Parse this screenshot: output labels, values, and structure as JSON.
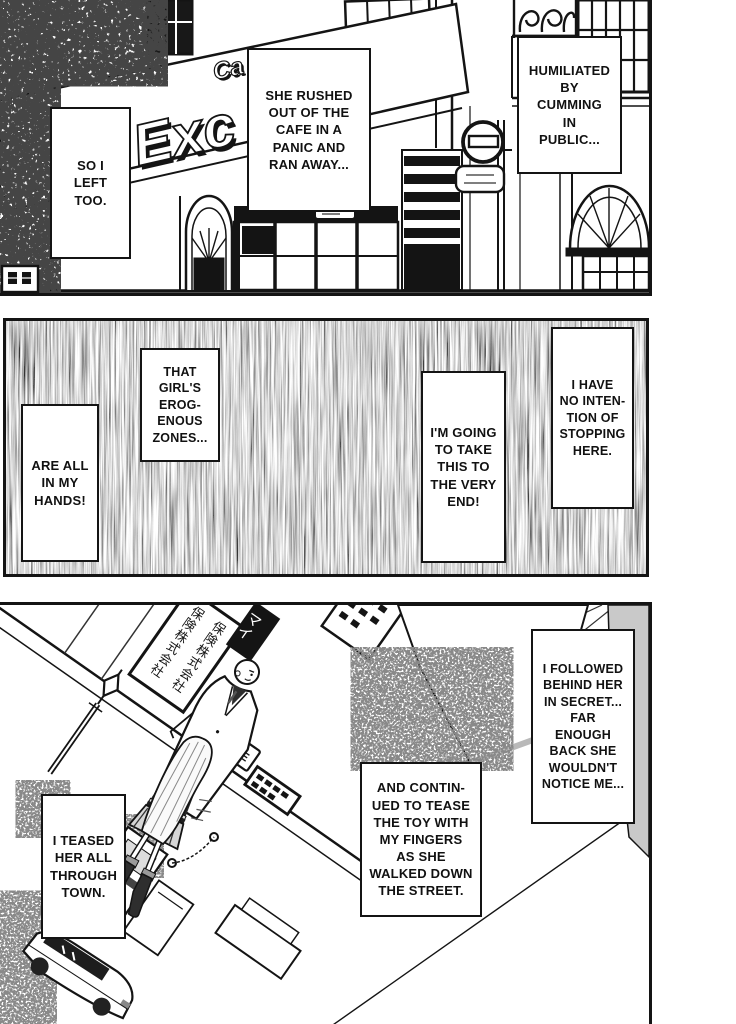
{
  "page": {
    "kind": "manga page, black and white, three vertical panels",
    "paper_color": "#ffffff",
    "ink_color": "#141414",
    "gray_wall_color": "#c9c9c9"
  },
  "panel1": {
    "scene": "european cafe storefront exterior with ivy and a no-entry street sign",
    "cafe_sign": {
      "prefix": "Ca",
      "script": "Exc"
    },
    "captions": {
      "so_i_left": "SO I\nLEFT\nTOO.",
      "she_rushed": "SHE RUSHED\nOUT OF THE\nCAFE IN A\nPANIC AND\nRAN AWAY...",
      "humiliated": "HUMILIATED\nBY\nCUMMING\nIN\nPUBLIC..."
    }
  },
  "panel2": {
    "scene": "dark scratchy static background with floating narration boxes",
    "captions": {
      "that_girls": "THAT\nGIRL'S\nEROG-\nENOUS\nZONES...",
      "are_all": "ARE ALL\nIN MY\nHANDS!",
      "im_going": "I'M GOING\nTO TAKE\nTHIS TO\nTHE VERY\nEND!",
      "i_have": "I HAVE\nNO INTEN-\nTION OF\nSTOPPING\nHERE."
    }
  },
  "panel3": {
    "scene": "tilted street scene: schoolgirl walking ahead, man in coat following, shop signs, lamp post, parked car",
    "street_signs": {
      "company": "保険株式会社",
      "mai": "マイ",
      "good": "グッド",
      "dere": "DERE"
    },
    "captions": {
      "i_teased": "I TEASED\nHER ALL\nTHROUGH\nTOWN.",
      "and_continued": "AND CONTIN-\nUED TO TEASE\nTHE TOY WITH\nMY FINGERS\nAS SHE\nWALKED DOWN\nTHE STREET.",
      "i_followed": "I FOLLOWED\nBEHIND HER\nIN SECRET...\nFAR\nENOUGH\nBACK SHE\nWOULDN'T\nNOTICE ME..."
    }
  }
}
